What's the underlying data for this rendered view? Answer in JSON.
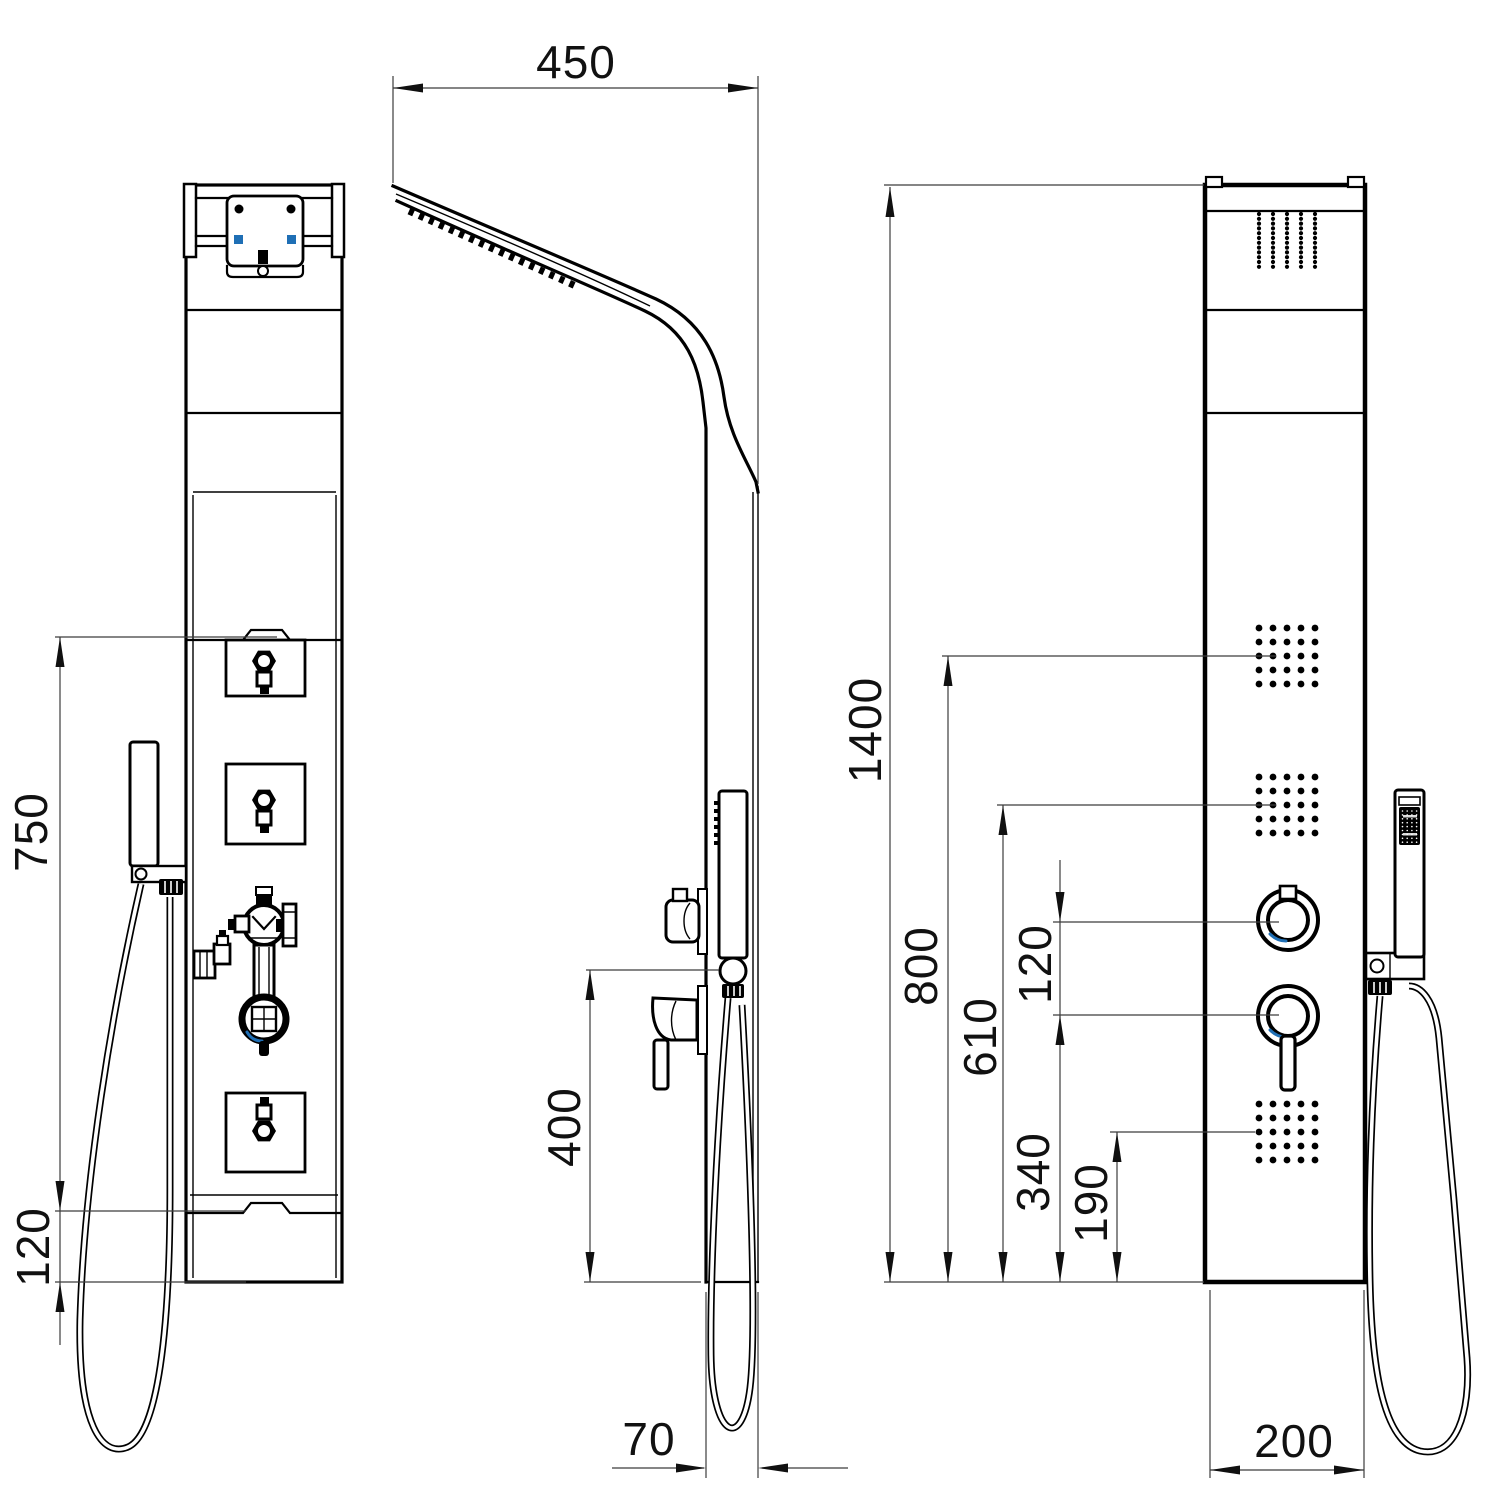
{
  "dimensions": {
    "head_overhang": "450",
    "back_panel_upper": "750",
    "back_panel_lower": "120",
    "hand_shower_height": "400",
    "panel_depth": "70",
    "total_height": "1400",
    "upper_jets": "800",
    "middle_jets": "610",
    "knob_spacing": "120",
    "mixer_height": "340",
    "lower_jets": "190",
    "panel_width": "200"
  },
  "colors": {
    "line": "#000000",
    "dimension_line": "#3c3c3c",
    "accent_blue": "#1f6fb5",
    "background": "#ffffff"
  }
}
